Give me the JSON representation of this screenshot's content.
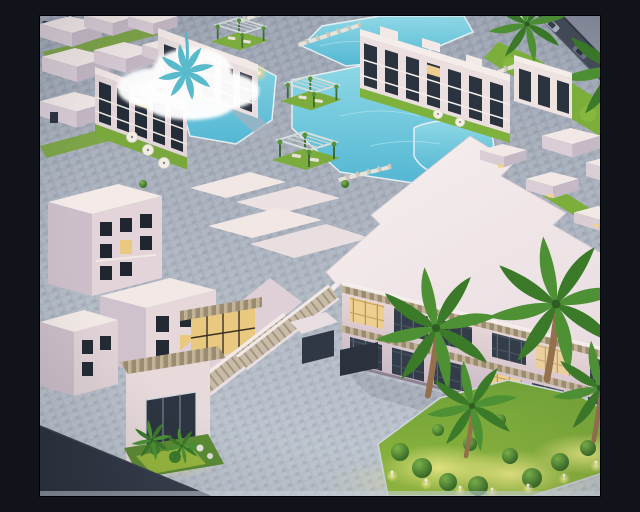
{
  "scene": {
    "description": "Aerial dusk 3D architectural rendering of a white resort residential complex with interconnected turquoise swimming pools, pergola cabanas, sun loungers, palm trees, a large angular clubhouse with exterior staircases and lit glass windows, cobblestone plazas, an illuminated topiary garden island, and a perimeter road with cars",
    "time_of_day": "dusk",
    "render_style": "isometric aerial visualization",
    "visible_text": ""
  },
  "palette": {
    "sky_outside": "#8b90a1",
    "pavement": "#9aa3b2",
    "pavement_light": "#b9c1cb",
    "pool_water_light": "#8ed8e6",
    "pool_water_dark": "#54b7d3",
    "building_white": "#f3e9e7",
    "building_shadow_face": "#c9bac6",
    "window_glass": "#333d4a",
    "window_lit": "#eecf90",
    "grass": "#7aa43c",
    "grass_lit": "#c6d63f",
    "palm_frond": "#4d9134",
    "palm_trunk": "#95704d",
    "road": "#434a58",
    "dark_roof_wedge": "#262c37",
    "cloud_logo": "#ffffff",
    "cloud_logo_palm": "#58bacb",
    "pergola_slat": "#c3b294"
  },
  "objects": {
    "pools": {
      "label": "swimming pools",
      "count": 5
    },
    "cabanas": {
      "label": "pergola cabanas on grass pads",
      "count": 4
    },
    "lounger_rows": {
      "label": "sun lounger rows",
      "count": 4
    },
    "palm_trees": {
      "label": "palm trees",
      "count": 6
    },
    "garden_island": {
      "label": "illuminated garden island",
      "topiary_count": 13,
      "bollard_lights": 8
    },
    "road": {
      "label": "perimeter road",
      "cars": 4,
      "trucks": 1
    },
    "clubhouse": {
      "label": "angular white clubhouse with exterior staircases",
      "staircases": 2,
      "lit_windows": 4
    },
    "housing": {
      "label": "white villa and apartment clusters",
      "clusters": 4
    },
    "logo": {
      "label": "white cloud watermark with teal palm silhouette",
      "count": 1
    }
  }
}
